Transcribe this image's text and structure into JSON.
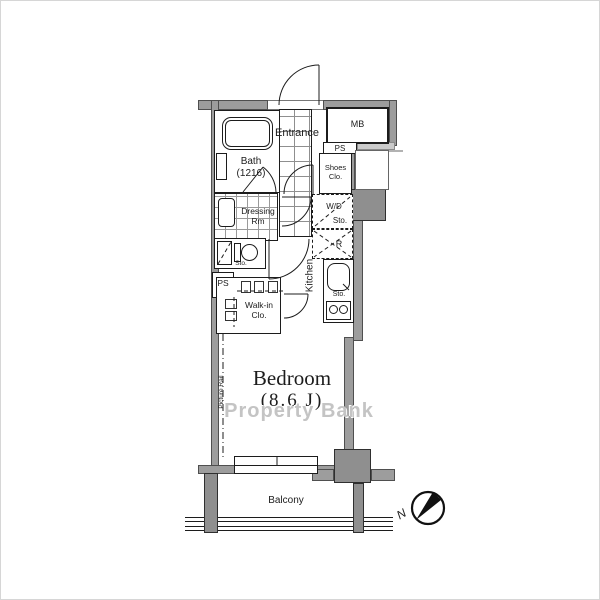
{
  "labels": {
    "entrance": "Entrance",
    "mb": "MB",
    "ps_top": "PS",
    "shoes_line1": "Shoes",
    "shoes_line2": "Clo.",
    "bath_line1": "Bath",
    "bath_line2": "(1216)",
    "dressing_line1": "Dressing",
    "dressing_line2": "Rm",
    "toilet_sto": "Sto.",
    "wd_line1": "W/D",
    "wd_line2": "Sto.",
    "fridge": "R",
    "kitchen": "Kitchen",
    "kitchen_sto": "Sto.",
    "ps_left": "PS",
    "walkin_line1": "Walk-in",
    "walkin_line2": "Clo.",
    "picture_rail": "Picture Rail",
    "bedroom": "Bedroom",
    "bedroom_size": "(8.6 J)",
    "balcony": "Balcony",
    "compass_n": "N"
  },
  "watermark": "Property Bank",
  "colors": {
    "wall": "#9d9d9d",
    "pillar": "#8f8f8f",
    "light_wall": "#cbcbcb",
    "line": "#1c1c1c",
    "watermark": "#c4c4c4"
  }
}
